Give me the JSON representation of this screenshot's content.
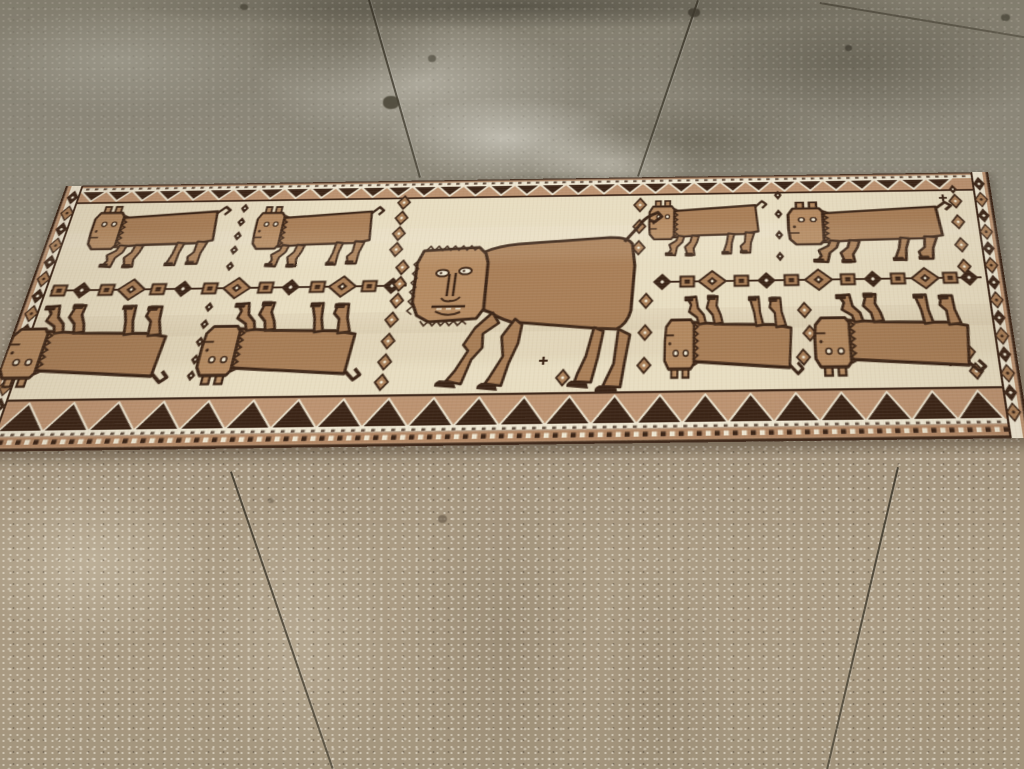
{
  "scene": {
    "subject": "antique tribal pictorial rug with lion figures lying on a stained concrete floor",
    "view": "oblique elevated view, rug receding toward top of frame",
    "text_content": "none"
  },
  "palette": {
    "floor_upper": "#8a8476",
    "floor_lower": "#a5957d",
    "floor_joint": "#45402f",
    "rug_field": "#e8ddc1",
    "rug_camel": "#a87e57",
    "rug_camel_light": "#b48a61",
    "rug_dark_brown": "#3a2416",
    "rug_tan_band": "#bb9270",
    "rug_ivory": "#efe7d2",
    "rug_guard_tan": "#b28866"
  },
  "rug_design": {
    "canvas": {
      "w": 940,
      "h": 280
    },
    "central_figure": "large lion with human face, facing left, tail curled up at right",
    "border_pattern": "inward-pointing zigzag triangles top and bottom, diamond columns on sides, dotted guard stripes",
    "small_animals": [
      {
        "x": 40,
        "y": 24,
        "w": 137,
        "h": 73,
        "inv": false
      },
      {
        "x": 204,
        "y": 27,
        "w": 128,
        "h": 72,
        "inv": false
      },
      {
        "x": 596,
        "y": 27,
        "w": 119,
        "h": 66,
        "inv": false
      },
      {
        "x": 733,
        "y": 31,
        "w": 166,
        "h": 72,
        "inv": false
      },
      {
        "x": -2,
        "y": 134,
        "w": 161,
        "h": 87,
        "inv": true
      },
      {
        "x": 181,
        "y": 134,
        "w": 156,
        "h": 87,
        "inv": true
      },
      {
        "x": 614,
        "y": 134,
        "w": 130,
        "h": 87,
        "inv": true
      },
      {
        "x": 753,
        "y": 134,
        "w": 158,
        "h": 87,
        "inv": true
      }
    ],
    "chain": {
      "y": 120,
      "left": [
        {
          "x": 30,
          "t": "sq"
        },
        {
          "x": 52,
          "t": "dd"
        },
        {
          "x": 76,
          "t": "sq"
        },
        {
          "x": 100,
          "t": "cd"
        },
        {
          "x": 126,
          "t": "sq"
        },
        {
          "x": 150,
          "t": "dd"
        },
        {
          "x": 176,
          "t": "sq"
        },
        {
          "x": 202,
          "t": "cd"
        },
        {
          "x": 230,
          "t": "sq"
        },
        {
          "x": 254,
          "t": "dd"
        },
        {
          "x": 280,
          "t": "sq"
        },
        {
          "x": 304,
          "t": "cd"
        },
        {
          "x": 330,
          "t": "sq"
        },
        {
          "x": 352,
          "t": "dd"
        }
      ],
      "right": [
        {
          "x": 612,
          "t": "dd"
        },
        {
          "x": 636,
          "t": "sq"
        },
        {
          "x": 660,
          "t": "cd"
        },
        {
          "x": 688,
          "t": "sq"
        },
        {
          "x": 712,
          "t": "dd"
        },
        {
          "x": 736,
          "t": "sq"
        },
        {
          "x": 762,
          "t": "cd"
        },
        {
          "x": 790,
          "t": "sq"
        },
        {
          "x": 814,
          "t": "dd"
        },
        {
          "x": 838,
          "t": "sq"
        },
        {
          "x": 864,
          "t": "cd"
        },
        {
          "x": 888,
          "t": "sq"
        },
        {
          "x": 906,
          "t": "dd"
        }
      ]
    },
    "rosette_columns": [
      {
        "x": 190,
        "type": "dot",
        "ys": [
          30,
          46,
          62,
          78,
          96
        ]
      },
      {
        "x": 350,
        "type": "ros",
        "ys": [
          26,
          44,
          62,
          80
        ]
      },
      {
        "x": 359,
        "type": "ros",
        "ys": [
          100,
          118,
          136
        ]
      },
      {
        "x": 357,
        "type": "ros",
        "ys": [
          156,
          178,
          199,
          219
        ]
      },
      {
        "x": 588,
        "type": "ros",
        "ys": [
          33,
          58,
          82
        ]
      },
      {
        "x": 597,
        "type": "ros",
        "ys": [
          140,
          173,
          206
        ]
      },
      {
        "x": 726,
        "type": "dot",
        "ys": [
          24,
          46,
          70,
          94
        ]
      },
      {
        "x": 903,
        "type": "ros",
        "ys": [
          34,
          58,
          84,
          108
        ]
      },
      {
        "x": 180,
        "type": "dot",
        "ys": [
          140,
          158,
          176,
          194,
          210
        ]
      }
    ],
    "scatter": [
      {
        "t": "ros",
        "x": 523,
        "y": 217
      },
      {
        "t": "cross",
        "x": 504,
        "y": 200
      },
      {
        "t": "cross",
        "x": 545,
        "y": 208
      },
      {
        "t": "ros",
        "x": 747,
        "y": 152
      },
      {
        "t": "ros",
        "x": 751,
        "y": 176
      },
      {
        "t": "ros",
        "x": 744,
        "y": 200
      },
      {
        "t": "cross",
        "x": 868,
        "y": 180
      },
      {
        "t": "ros",
        "x": 888,
        "y": 178
      },
      {
        "t": "ros",
        "x": 896,
        "y": 197
      },
      {
        "t": "cross",
        "x": 878,
        "y": 207
      },
      {
        "t": "ros",
        "x": 901,
        "y": 216
      },
      {
        "t": "cross",
        "x": 891,
        "y": 30
      },
      {
        "t": "dot",
        "x": 902,
        "y": 20
      }
    ],
    "border": {
      "span": [
        18,
        922
      ],
      "top_tri_w": 26,
      "top_tri_y": 7,
      "top_tri_h": 12,
      "bottom_tri_w": 41,
      "bottom_tri_base": 262,
      "bottom_tri_h": 27
    },
    "side_diamonds": {
      "left_cx": 11,
      "right_cx": 929,
      "start": 14,
      "end": 272,
      "step": 18.6
    },
    "guard_dots": {
      "y": 269.5,
      "size": 4.5,
      "step": 8,
      "x0": 22,
      "x1": 918
    },
    "dash_rows": [
      {
        "y": 3.5,
        "x0": 22,
        "x1": 918,
        "step": 9
      },
      {
        "y": 263.6,
        "x0": 22,
        "x1": 918,
        "step": 9
      }
    ]
  },
  "floor_joints": [
    {
      "x": 368,
      "y": 0,
      "len": 185,
      "rot": -16,
      "type": "v"
    },
    {
      "x": 697,
      "y": 0,
      "len": 186,
      "rot": 18.8,
      "type": "v"
    },
    {
      "x": 820,
      "y": 2,
      "len": 207,
      "rot": 9.5,
      "type": "h"
    },
    {
      "x": 230,
      "y": 472,
      "len": 314,
      "rot": -18.9,
      "type": "v"
    },
    {
      "x": 897,
      "y": 467,
      "len": 310,
      "rot": 13.2,
      "type": "v"
    }
  ],
  "floor_spots": [
    {
      "x": 383,
      "y": 96,
      "w": 16,
      "h": 13,
      "c": "rgba(70,66,52,.85)"
    },
    {
      "x": 428,
      "y": 55,
      "w": 8,
      "h": 7,
      "c": "rgba(80,76,62,.7)"
    },
    {
      "x": 688,
      "y": 8,
      "w": 12,
      "h": 9,
      "c": "rgba(62,58,46,.8)"
    },
    {
      "x": 240,
      "y": 4,
      "w": 8,
      "h": 6,
      "c": "rgba(70,66,52,.7)"
    },
    {
      "x": 1001,
      "y": 14,
      "w": 9,
      "h": 7,
      "c": "rgba(66,62,50,.7)"
    },
    {
      "x": 438,
      "y": 515,
      "w": 9,
      "h": 8,
      "c": "rgba(96,84,66,.6)"
    },
    {
      "x": 268,
      "y": 498,
      "w": 6,
      "h": 5,
      "c": "rgba(100,88,70,.5)"
    },
    {
      "x": 845,
      "y": 45,
      "w": 7,
      "h": 6,
      "c": "rgba(60,56,45,.7)"
    }
  ]
}
